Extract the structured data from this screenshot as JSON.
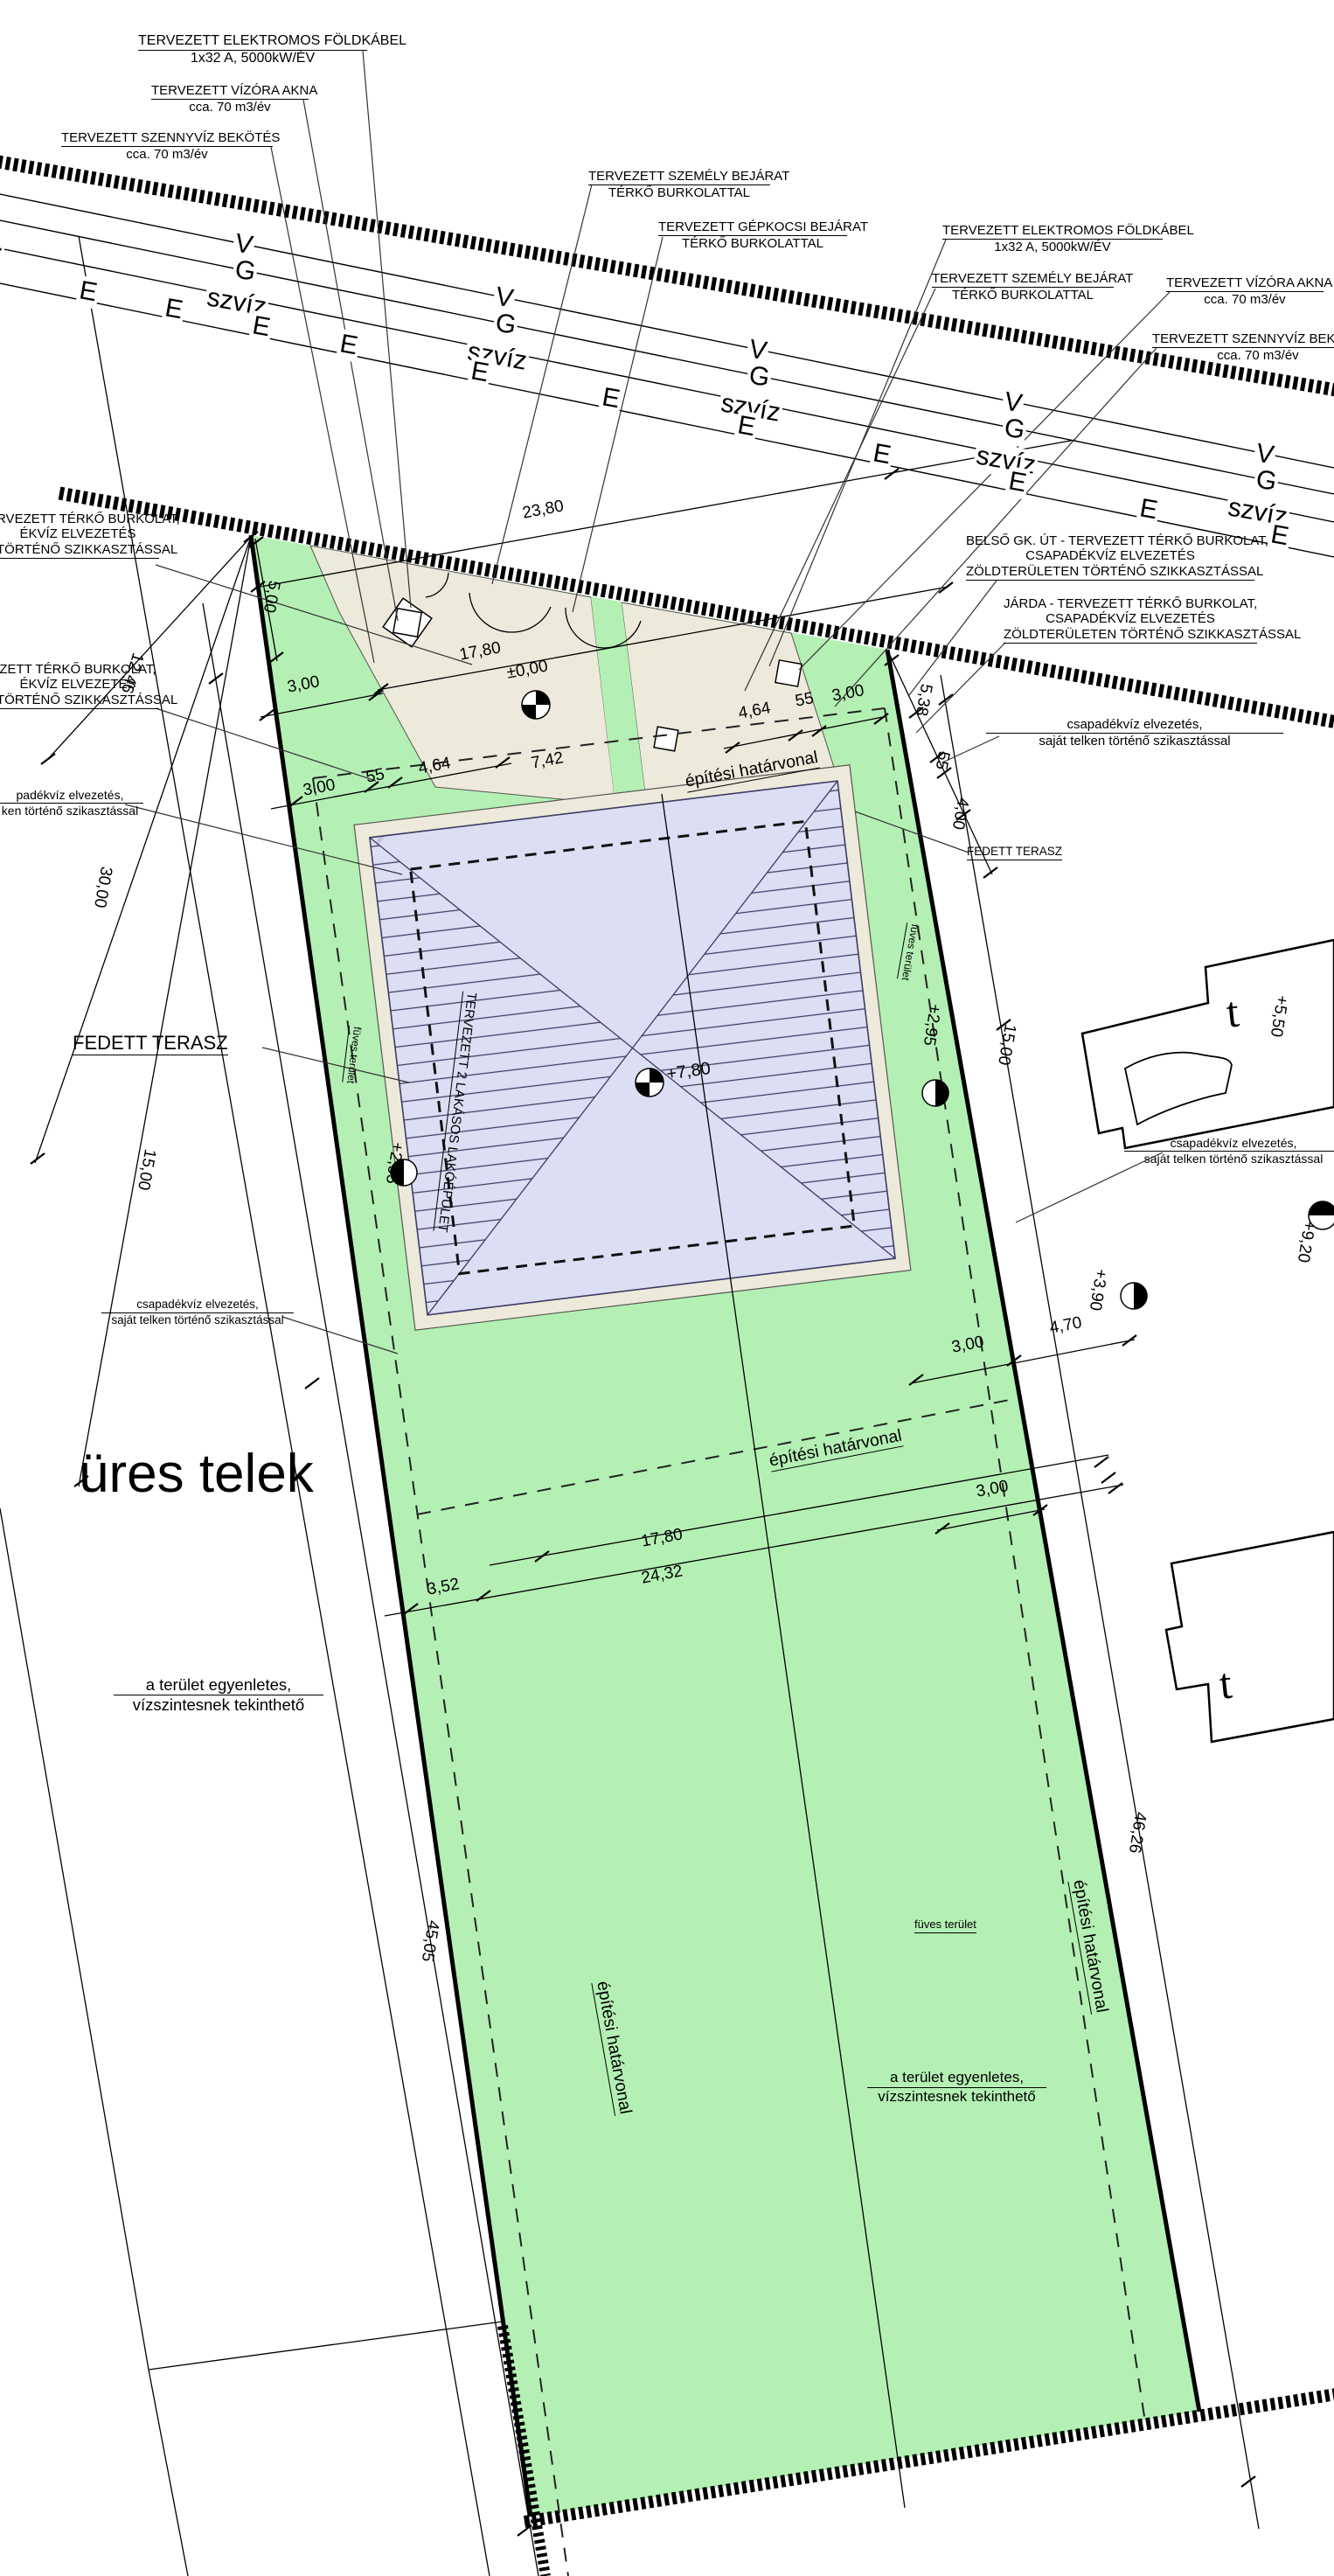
{
  "callouts": {
    "elektromos": {
      "title": "TERVEZETT ELEKTROMOS FÖLDKÁBEL",
      "sub": "1x32 A, 5000kW/ÉV"
    },
    "vizora": {
      "title": "TERVEZETT VÍZÓRA AKNA",
      "sub": "cca. 70 m3/év"
    },
    "szennyviz": {
      "title": "TERVEZETT SZENNYVÍZ BEKÖTÉS",
      "sub": "cca. 70 m3/év"
    },
    "szemely": {
      "title": "TERVEZETT SZEMÉLY BEJÁRAT",
      "sub": "TÉRKŐ BURKOLATTAL"
    },
    "gepkocsi": {
      "title": "TERVEZETT GÉPKOCSI BEJÁRAT",
      "sub": "TÉRKŐ BURKOLATTAL"
    },
    "belso_ut": {
      "line1": "BELSŐ GK. ÚT - TERVEZETT TÉRKŐ BURKOLAT,",
      "line2": "CSAPADÉKVÍZ ELVEZETÉS",
      "line3": "ZÖLDTERÜLETEN TÖRTÉNŐ SZIKKASZTÁSSAL"
    },
    "jarda": {
      "line1": "JÁRDA - TERVEZETT TÉRKŐ BURKOLAT,",
      "line2": "CSAPADÉKVÍZ ELVEZETÉS",
      "line3": "ZÖLDTERÜLETEN TÖRTÉNŐ SZIKKASZTÁSSAL"
    },
    "left_burkolat_1": {
      "line1": "RVEZETT TÉRKŐ BURKOLAT,",
      "line2": "ÉKVÍZ ELVEZETÉS",
      "line3": "TÖRTÉNŐ SZIKKASZTÁSSAL"
    },
    "left_burkolat_2": {
      "line1": "ZETT TÉRKŐ BURKOLAT,",
      "line2": "ÉKVÍZ ELVEZETÉS",
      "line3": "TÖRTÉNŐ SZIKKASZTÁSSAL"
    },
    "csapadek": {
      "line1": "csapadékvíz elvezetés,",
      "line2": "saját telken történő szikasztással"
    },
    "csapadek_left": {
      "line1": "padékvíz elvezetés,",
      "line2": "ken történő szikasztással"
    }
  },
  "utility": {
    "v": "V",
    "g": "G",
    "szviz": "szvíz",
    "e": "E"
  },
  "dims": {
    "d23_80": "23,80",
    "d5_00": "5,00",
    "d12_46": "12,46",
    "d30_00": "30,00",
    "d3_00": "3,00",
    "d55": "55",
    "d4_64": "4,64",
    "d7_42": "7,42",
    "d17_80": "17,80",
    "d5_38": "5,38",
    "d4_00": "4,00",
    "d15_00": "15,00",
    "d3_52": "3,52",
    "d24_32": "24,32",
    "d4_70": "4,70",
    "d45_05": "45,05",
    "d46_26": "46,26"
  },
  "elevations": {
    "e0": "±0,00",
    "e780": "+7,80",
    "e295": "+2,95",
    "e550": "+5,50",
    "e920": "+9,20",
    "e390": "+3,90"
  },
  "labels": {
    "ures_telek": "üres telek",
    "fedett_terasz": "FEDETT TERASZ",
    "fuves_terulet": "füves terület",
    "epitesi_hatarvonal": "építési határvonal",
    "building": "TERVEZETT 2 LAKÁSOS LAKÓÉPÜLET",
    "terrain1": "a terület egyenletes,",
    "terrain2": "vízszintesnek tekinthető",
    "t": "t"
  },
  "colors": {
    "green": "#b4f0b4",
    "paving": "#edeadb",
    "roof": "#dcdef4",
    "roof_line": "#3c3c64"
  }
}
